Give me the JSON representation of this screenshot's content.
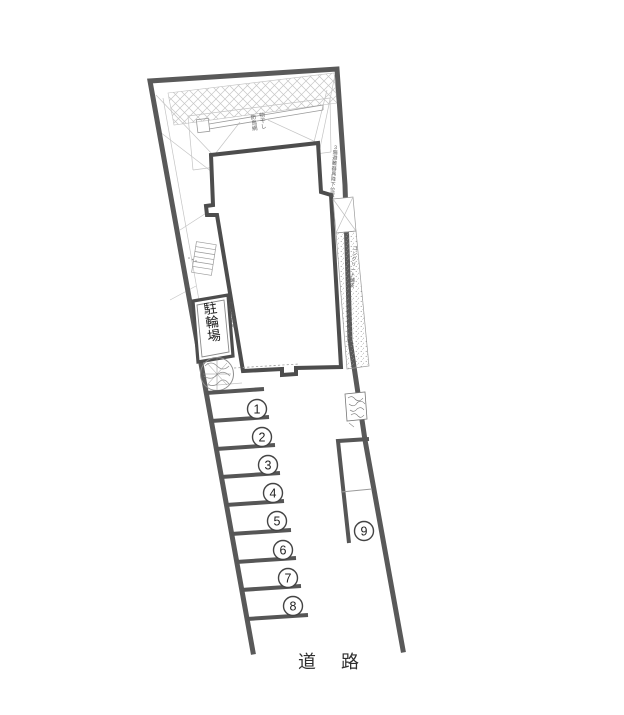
{
  "plan": {
    "kind": "建物配置図 (site plan)",
    "labels": {
      "bicycle_parking": "駐輪場",
      "road": "道 路"
    },
    "annotations": {
      "top_note_1": "防鳥網",
      "top_note_2": "物干し",
      "right_upper_note": "3階避難器具降下位置",
      "left_note": "6階避難器具降下位置",
      "bike_side_note": "自転車置場",
      "paving_note": "コンクリート舗装"
    },
    "parking": {
      "stalls": [
        {
          "label": "1"
        },
        {
          "label": "2"
        },
        {
          "label": "3"
        },
        {
          "label": "4"
        },
        {
          "label": "5"
        },
        {
          "label": "6"
        },
        {
          "label": "7"
        },
        {
          "label": "8"
        },
        {
          "label": "9"
        }
      ]
    },
    "colors": {
      "boundary": "#595959",
      "building": "#4d4d4d",
      "thin_line": "#bdbdbd",
      "hatch": "#c6c6c6",
      "stipple": "#8f8f8f",
      "text": "#333333"
    }
  }
}
